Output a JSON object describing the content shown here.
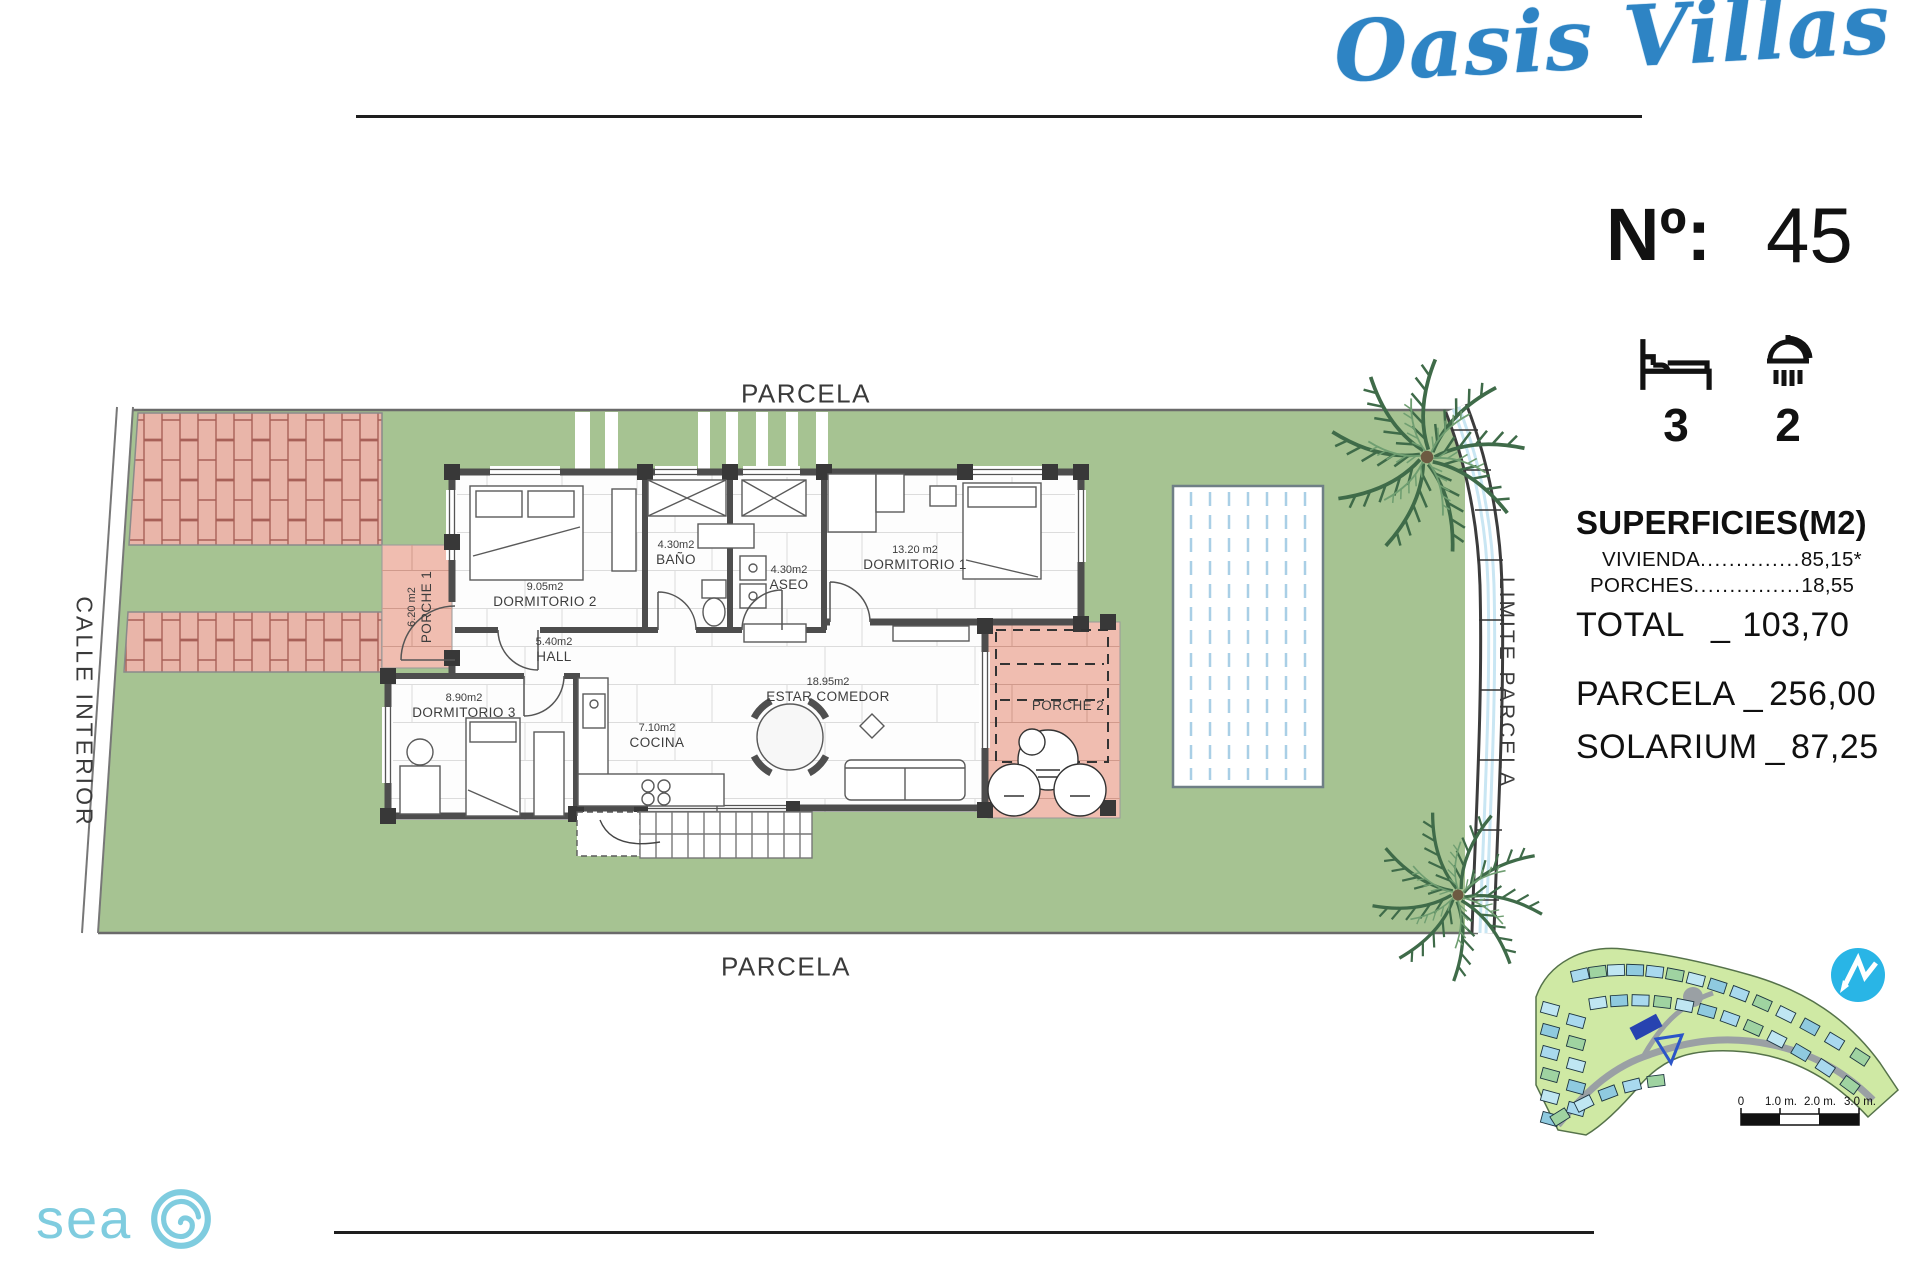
{
  "brand": {
    "name": "Oasis Villas",
    "accent_color": "#2e84c4"
  },
  "header": {
    "no_label": "Nº:",
    "no_value": "45",
    "bedrooms": "3",
    "bathrooms": "2"
  },
  "surfaces": {
    "title": "SUPERFICIES(M2)",
    "vivienda": {
      "label": "VIVIENDA",
      "dots": "..............",
      "value": "85,15*"
    },
    "porches": {
      "label": "PORCHES",
      "dots": "...............",
      "value": "18,55"
    },
    "total": {
      "label": "TOTAL",
      "sep": "_",
      "value": "103,70"
    },
    "parcela": {
      "label": "PARCELA",
      "sep": "_",
      "value": "256,00"
    },
    "solarium": {
      "label": "SOLARIUM",
      "sep": "_",
      "value": "87,25"
    }
  },
  "plan": {
    "parcela_top": "PARCELA",
    "parcela_bottom": "PARCELA",
    "calle": "CALLE INTERIOR",
    "limite": "LIMITE PARCELA",
    "rooms": {
      "dormitorio1": {
        "area": "13.20 m2",
        "name": "DORMITORIO 1"
      },
      "dormitorio2": {
        "area": "9.05m2",
        "name": "DORMITORIO 2"
      },
      "dormitorio3": {
        "area": "8.90m2",
        "name": "DORMITORIO 3"
      },
      "bano": {
        "area": "4.30m2",
        "name": "BAÑO"
      },
      "aseo": {
        "area": "4.30m2",
        "name": "ASEO"
      },
      "hall": {
        "area": "5.40m2",
        "name": "HALL"
      },
      "cocina": {
        "area": "7.10m2",
        "name": "COCINA"
      },
      "estar": {
        "area": "18.95m2",
        "name": "ESTAR COMEDOR"
      },
      "porche1": {
        "area": "6.20 m2",
        "name": "PORCHE 1"
      },
      "porche2": {
        "name": "PORCHE 2"
      }
    },
    "colors": {
      "lawn": "#a6c392",
      "paving": "#e9b5a9",
      "porch": "#f0bdb0",
      "pool_stripe": "#a9cfe6",
      "wall": "#4d4d4d"
    }
  },
  "sitemap": {
    "scale_labels": [
      "0",
      "1.0 m.",
      "2.0 m.",
      "3.0 m."
    ],
    "compass": "north-arrow"
  },
  "footer": {
    "logo": "sea"
  }
}
